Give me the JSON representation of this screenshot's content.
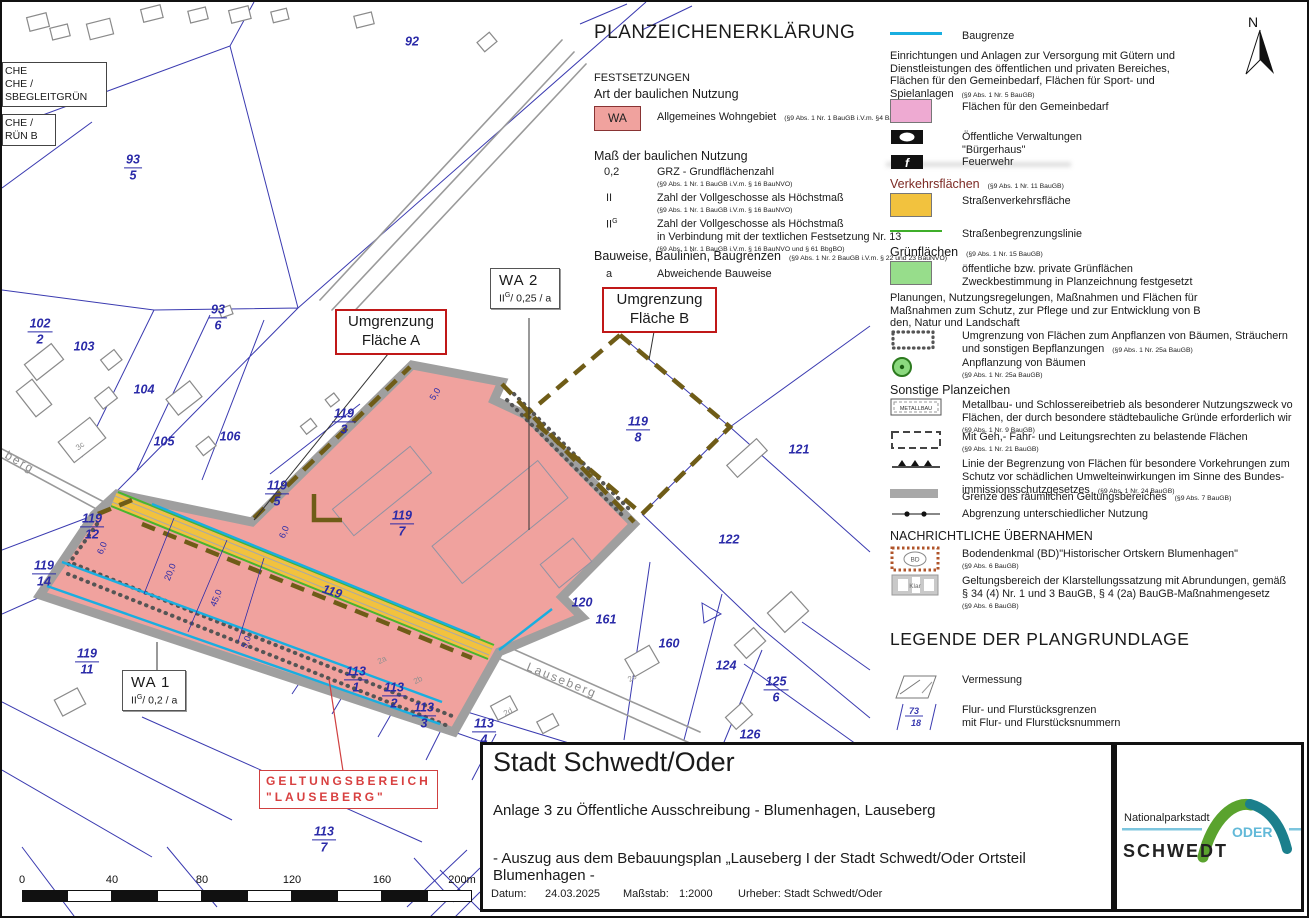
{
  "colors": {
    "wa_pink": "#f0a29e",
    "gemeinbedarf_pink": "#eeaad2",
    "verkehr_orange": "#f2c23e",
    "gruen": "#97dd8b",
    "baugrenze_cyan": "#19aee0",
    "strassenbegrenzung_gruen": "#3fae2a",
    "pflanz_braun": "#6f5c17",
    "kataster_blau": "#3a3ab0",
    "annotation_rot": "#cc2020",
    "logo_gruen": "#5aa32e",
    "logo_petrol": "#1b7f8c",
    "logo_hellblau": "#6fc5e0"
  },
  "north": {
    "label": "N"
  },
  "map": {
    "cut_boxes": [
      {
        "x": 0,
        "y": 60,
        "w": 98,
        "lines": [
          "CHE",
          "CHE /",
          "SBEGLEITGRÜN"
        ]
      },
      {
        "x": 0,
        "y": 112,
        "w": 47,
        "lines": [
          "CHE /",
          "RÜN B"
        ]
      }
    ],
    "parcels": [
      {
        "n": "93",
        "d": "5",
        "x": 131,
        "y": 166
      },
      {
        "n": "102",
        "d": "2",
        "x": 38,
        "y": 330
      },
      {
        "n": "103",
        "x": 82,
        "y": 345
      },
      {
        "n": "104",
        "x": 142,
        "y": 388
      },
      {
        "n": "105",
        "x": 162,
        "y": 440
      },
      {
        "n": "106",
        "x": 228,
        "y": 435
      },
      {
        "n": "93",
        "d": "6",
        "x": 216,
        "y": 316
      },
      {
        "n": "92",
        "x": 410,
        "y": 40
      },
      {
        "n": "119",
        "d": "3",
        "x": 342,
        "y": 420
      },
      {
        "n": "119",
        "d": "5",
        "x": 275,
        "y": 492
      },
      {
        "n": "119",
        "d": "7",
        "x": 400,
        "y": 522
      },
      {
        "n": "119",
        "d": "8",
        "x": 636,
        "y": 428
      },
      {
        "n": "119",
        "d": "12",
        "x": 90,
        "y": 525
      },
      {
        "n": "119",
        "d": "14",
        "x": 42,
        "y": 572
      },
      {
        "n": "119",
        "d": "11",
        "x": 85,
        "y": 660
      },
      {
        "n": "121",
        "x": 797,
        "y": 448
      },
      {
        "n": "122",
        "x": 727,
        "y": 538
      },
      {
        "n": "120",
        "x": 580,
        "y": 601
      },
      {
        "n": "161",
        "x": 604,
        "y": 618
      },
      {
        "n": "160",
        "x": 667,
        "y": 642
      },
      {
        "n": "124",
        "x": 724,
        "y": 664
      },
      {
        "n": "125",
        "d": "6",
        "x": 774,
        "y": 688
      },
      {
        "n": "126",
        "x": 748,
        "y": 733
      },
      {
        "n": "113",
        "d": "1",
        "x": 354,
        "y": 678
      },
      {
        "n": "113",
        "d": "2",
        "x": 392,
        "y": 694
      },
      {
        "n": "113",
        "d": "3",
        "x": 422,
        "y": 714
      },
      {
        "n": "113",
        "d": "4",
        "x": 482,
        "y": 730
      },
      {
        "n": "113",
        "d": "7",
        "x": 322,
        "y": 838
      },
      {
        "n": "119",
        "x": 330,
        "y": 590,
        "rot": 18
      }
    ],
    "streets": [
      {
        "t": "Lauseberg",
        "x": 560,
        "y": 678,
        "rot": 22
      },
      {
        "t": "berg",
        "x": 18,
        "y": 460,
        "rot": 30
      }
    ],
    "house_labels": [
      {
        "t": "3c",
        "x": 78,
        "y": 444,
        "rot": -38
      },
      {
        "t": "2a",
        "x": 380,
        "y": 658,
        "rot": -28
      },
      {
        "t": "2b",
        "x": 416,
        "y": 678,
        "rot": -28
      },
      {
        "t": "2c",
        "x": 630,
        "y": 676,
        "rot": -30
      },
      {
        "t": "2d",
        "x": 506,
        "y": 710,
        "rot": -28
      }
    ],
    "dims": [
      {
        "t": "20,0",
        "x": 168,
        "y": 570,
        "rot": -68
      },
      {
        "t": "45,0",
        "x": 214,
        "y": 596,
        "rot": -68
      },
      {
        "t": "5,0",
        "x": 244,
        "y": 640,
        "rot": -68
      },
      {
        "t": "6,0",
        "x": 100,
        "y": 546,
        "rot": -68
      },
      {
        "t": "6,0",
        "x": 282,
        "y": 530,
        "rot": -68
      },
      {
        "t": "5,0",
        "x": 433,
        "y": 392,
        "rot": -58
      }
    ],
    "wa2": {
      "name": "WA 2",
      "roman": "II",
      "sup": "G",
      "rest": "/ 0,25 / a"
    },
    "wa1": {
      "name": "WA 1",
      "roman": "II",
      "sup": "G",
      "rest": "/ 0,2 / a"
    },
    "red_a": {
      "l1": "Umgrenzung",
      "l2": "Fläche A"
    },
    "red_b": {
      "l1": "Umgrenzung",
      "l2": "Fläche B"
    },
    "geltung": {
      "l1": "GELTUNGSBEREICH",
      "l2": "\"LAUSEBERG\""
    },
    "scale": {
      "labels": [
        {
          "t": "0",
          "x": 20
        },
        {
          "t": "40",
          "x": 110
        },
        {
          "t": "80",
          "x": 200
        },
        {
          "t": "120",
          "x": 290
        },
        {
          "t": "160",
          "x": 380
        },
        {
          "t": "200m",
          "x": 460
        }
      ],
      "segments": 10
    }
  },
  "legend": {
    "title": "PLANZEICHENERKLÄRUNG",
    "festsetzungen": "FESTSETZUNGEN",
    "art_heading": "Art der baulichen Nutzung",
    "wa": {
      "sym": "WA",
      "label": "Allgemeines Wohngebiet",
      "ref": "(§9 Abs. 1 Nr. 1 BauGB i.V.m. §4 BauNVO)"
    },
    "mass_heading": "Maß der baulichen Nutzung",
    "grz": {
      "sym": "0,2",
      "label": "GRZ - Grundflächenzahl",
      "ref": "(§9 Abs. 1 Nr. 1 BauGB i.V.m. § 16 BauNVO)"
    },
    "geschosse": {
      "sym": "II",
      "label": "Zahl der Vollgeschosse als Höchstmaß",
      "ref": "(§9 Abs. 1 Nr. 1 BauGB i.V.m. § 16 BauNVO)"
    },
    "geschosse_g": {
      "sym": "II",
      "sup": "G",
      "label1": "Zahl der Vollgeschosse als Höchstmaß",
      "label2": "in Verbindung mit der textlichen Festsetzung Nr. 13",
      "ref": "(§9 Abs. 1 Nr. 1 BauGB i.V.m. § 16 BauNVO und § 61 BbgBO)"
    },
    "bauweise_heading": "Bauweise, Baulinien, Baugrenzen",
    "bauweise_ref": "(§9 Abs. 1 Nr. 2 BauGB i.V.m. § 22 und 23 BauNVO)",
    "abweichend": {
      "sym": "a",
      "label": "Abweichende Bauweise"
    },
    "right_items": [
      {
        "type": "line-cyan",
        "y": 26,
        "lines": [
          "Baugrenze"
        ]
      },
      {
        "type": "para",
        "y": 46,
        "lines": [
          "Einrichtungen und Anlagen zur Versorgung mit Gütern und",
          "Dienstleistungen des öffentlichen und privaten Bereiches,",
          "Flächen für den Gemeinbedarf, Flächen für Sport- und",
          "Spielanlagen"
        ],
        "ref": "(§9 Abs. 1 Nr. 5 BauGB)",
        "refInline": true
      },
      {
        "type": "swatch-pink",
        "y": 97,
        "lines": [
          "Flächen für den Gemeinbedarf"
        ]
      },
      {
        "type": "icon-verwaltung",
        "y": 127,
        "lines": [
          "Öffentliche Verwaltungen",
          "\"Bürgerhaus\""
        ]
      },
      {
        "type": "icon-feuerwehr",
        "y": 152,
        "lines": [
          "Feuerwehr"
        ]
      },
      {
        "type": "h-red",
        "y": 173,
        "lines": [
          "Verkehrsflächen"
        ],
        "ref": "(§9 Abs. 1 Nr. 11 BauGB)",
        "refInline": true
      },
      {
        "type": "swatch-orange",
        "y": 191,
        "lines": [
          "Straßenverkehrsfläche"
        ]
      },
      {
        "type": "line-green",
        "y": 224,
        "lines": [
          "Straßenbegrenzungslinie"
        ]
      },
      {
        "type": "h",
        "y": 241,
        "lines": [
          "Grünflächen"
        ],
        "ref": "(§9 Abs. 1 Nr. 15 BauGB)",
        "refInline": true
      },
      {
        "type": "swatch-green",
        "y": 259,
        "lines": [
          "öffentliche bzw. private Grünflächen",
          "Zweckbestimmung in Planzeichnung festgesetzt"
        ]
      },
      {
        "type": "para",
        "y": 288,
        "lines": [
          "Planungen, Nutzungsregelungen, Maßnahmen und Flächen für",
          "Maßnahmen zum Schutz, zur Pflege und zur Entwicklung von B",
          "den, Natur und Landschaft"
        ]
      },
      {
        "type": "icon-pflanz",
        "y": 326,
        "lines": [
          "Umgrenzung von Flächen zum Anpflanzen von Bäumen, Sträuchern",
          "und sonstigen Bepflanzungen"
        ],
        "ref": "(§9 Abs. 1 Nr. 25a BauGB)",
        "refInline": true
      },
      {
        "type": "icon-baum",
        "y": 353,
        "lines": [
          "Anpflanzung von Bäumen"
        ],
        "ref": "(§9 Abs. 1 Nr. 25a BauGB)"
      },
      {
        "type": "h",
        "y": 379,
        "lines": [
          "Sonstige Planzeichen"
        ]
      },
      {
        "type": "icon-metallbau",
        "y": 395,
        "lines": [
          "Metallbau- und Schlossereibetrieb als besonderer Nutzungszweck vo",
          "Flächen, der durch besondere städtebauliche Gründe erforderlich wir"
        ],
        "ref": "(§9 Abs. 1 Nr. 9 BauGB)"
      },
      {
        "type": "icon-gehrecht",
        "y": 427,
        "lines": [
          "Mit Geh,- Fahr- und Leitungsrechten zu belastende Flächen"
        ],
        "ref": "(§9 Abs. 1 Nr. 21 BauGB)"
      },
      {
        "type": "icon-schutz",
        "y": 454,
        "lines": [
          "Linie der Begrenzung von Flächen für besondere Vorkehrungen zum",
          "Schutz vor schädlichen Umwelteinwirkungen im Sinne des Bundes-",
          "immissionsschutzgesetzes"
        ],
        "ref": "(§9 Abs. 1 Nr. 24 BauGB)",
        "refInline": true
      },
      {
        "type": "icon-grenze",
        "y": 487,
        "lines": [
          "Grenze des räumlichen Geltungsbereiches"
        ],
        "ref": "(§9 Abs. 7 BauGB)",
        "refInline": true
      },
      {
        "type": "icon-abgrenzung",
        "y": 504,
        "lines": [
          "Abgrenzung unterschiedlicher Nutzung"
        ]
      },
      {
        "type": "h-caps",
        "y": 525,
        "lines": [
          "NACHRICHTLICHE ÜBERNAHMEN"
        ]
      },
      {
        "type": "icon-bd",
        "y": 544,
        "lines": [
          "Bodendenkmal (BD)\"Historischer Ortskern Blumenhagen\""
        ],
        "ref": "(§9 Abs. 6 BauGB)"
      },
      {
        "type": "icon-klar",
        "y": 571,
        "lines": [
          "Geltungsbereich der Klarstellungssatzung mit Abrundungen, gemäß",
          "§ 34 (4) Nr. 1 und 3 BauGB, § 4 (2a) BauGB-Maßnahmengesetz"
        ],
        "ref": "(§9 Abs. 6 BauGB)"
      },
      {
        "type": "big-title",
        "y": 625,
        "lines": [
          "LEGENDE DER PLANGRUNDLAGE"
        ]
      },
      {
        "type": "icon-vermessung",
        "y": 670,
        "lines": [
          "Vermessung"
        ]
      },
      {
        "type": "icon-flur",
        "y": 700,
        "lines": [
          "Flur- und Flurstücksgrenzen",
          "mit Flur- und Flurstücksnummern"
        ]
      }
    ]
  },
  "titleblock": {
    "title": "Stadt Schwedt/Oder",
    "line1": "Anlage 3 zu Öffentliche Ausschreibung - Blumenhagen, Lauseberg",
    "line2": "- Auszug aus dem Bebauungsplan „Lauseberg I der Stadt Schwedt/Oder Ortsteil Blumenhagen -",
    "meta": {
      "datum_label": "Datum:",
      "datum": "24.03.2025",
      "massstab_label": "Maßstab:",
      "massstab": "1:2000",
      "urheber": "Urheber: Stadt Schwedt/Oder"
    }
  },
  "logo": {
    "line1": "Nationalparkstadt",
    "name": "SCHWEDT",
    "oder": "ODER"
  }
}
